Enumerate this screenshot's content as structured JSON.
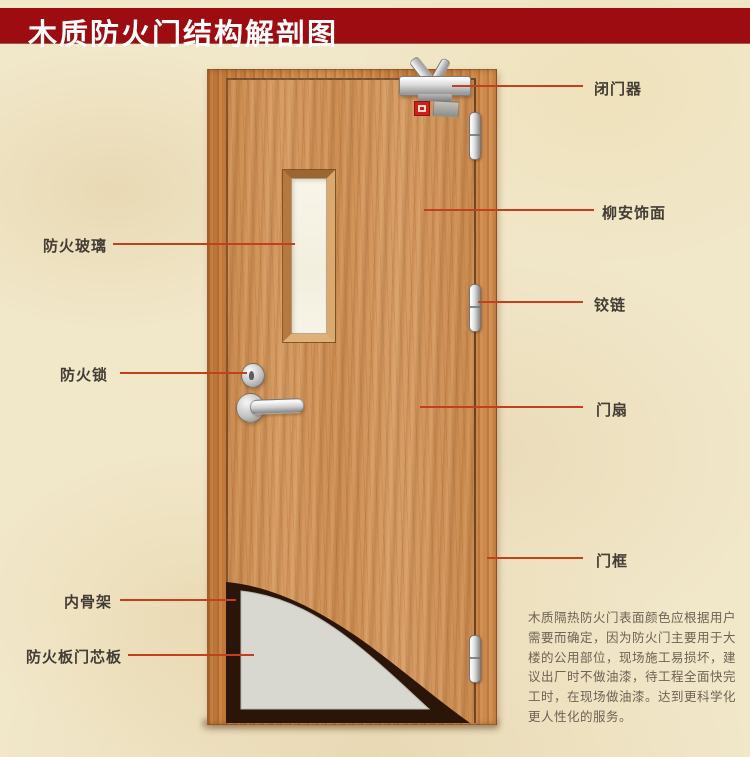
{
  "header": {
    "title": "木质防火门结构解剖图"
  },
  "labels": {
    "fire_glass": "防火玻璃",
    "fire_lock": "防火锁",
    "inner_skeleton": "内骨架",
    "core_board": "防火板门芯板",
    "door_closer": "闭门器",
    "veneer": "柳安饰面",
    "hinge": "铰链",
    "door_leaf": "门扇",
    "door_frame": "门框"
  },
  "description_lines": [
    "木质隔热防火门表面颜色应根据用户",
    "需要而确定，因为防火门主要用于大",
    "楼的公用部位，现场施工易损坏，建",
    "议出厂时不做油漆，待工程全面快完",
    "工时，在现场做油漆。达到更科学化",
    "更人性化的服务。"
  ],
  "colors": {
    "banner": "#9c0c10",
    "leader_line": "#c2401e",
    "background": "#f1e7c9",
    "leaf_wood": "#cf9156",
    "frame_wood": "#c57f41",
    "glass": "#f7f3e6",
    "core_gray": "#d9d8d0",
    "skeleton_dark": "#2a1508"
  }
}
